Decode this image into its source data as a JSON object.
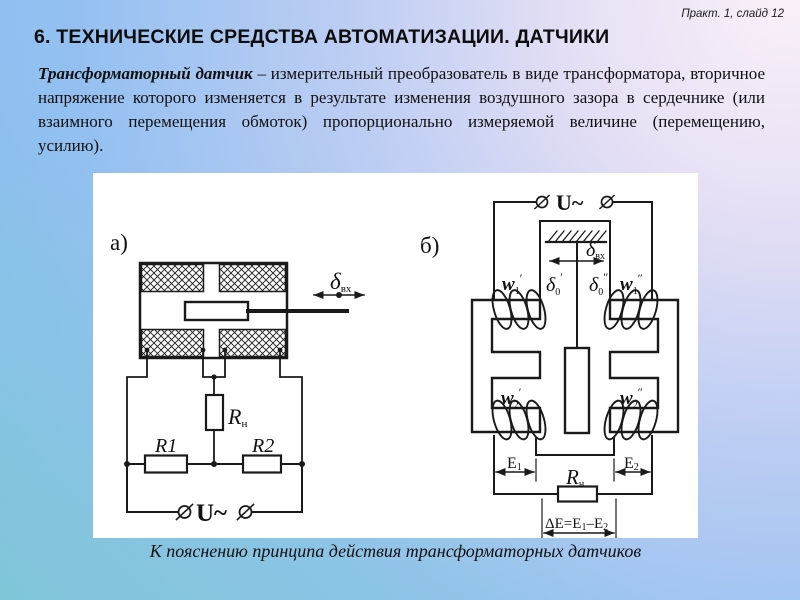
{
  "slide": {
    "ref": "Практ. 1, слайд 12",
    "title": "6. ТЕХНИЧЕСКИЕ СРЕДСТВА АВТОМАТИЗАЦИИ. ДАТЧИКИ"
  },
  "paragraph": {
    "lead": "Трансформаторный датчик",
    "rest": "– измерительный преобразователь в виде трансформатора, вторичное напряжение которого изменяется в результате изменения воздушного зазора в сердечнике (или взаимного перемещения обмоток) пропорционально измеряемой величине (перемещению, усилию)."
  },
  "figure": {
    "caption": "К пояснению принципа действия трансформаторных датчиков",
    "colors": {
      "ink": "#1a1a1a",
      "panel_bg": "#ffffff"
    },
    "panel_a": {
      "label": "а)",
      "delta_in": {
        "base": "δ",
        "sub": "вх"
      },
      "rn": {
        "base": "R",
        "sub": "н"
      },
      "r1": "R1",
      "r2": "R2",
      "supply": "U~"
    },
    "panel_b": {
      "label": "б)",
      "supply": "U~",
      "delta_in": {
        "base": "δ",
        "sub": "вх"
      },
      "delta0_left": {
        "base": "δ",
        "sub": "0",
        "sup": "′"
      },
      "delta0_right": {
        "base": "δ",
        "sub": "0",
        "sup": "″"
      },
      "w1_left": {
        "base": "w",
        "sub": "1",
        "sup": "′"
      },
      "w1_right": {
        "base": "w",
        "sub": "1",
        "sup": "″"
      },
      "w2_left": {
        "base": "w",
        "sub": "2",
        "sup": "′"
      },
      "w2_right": {
        "base": "w",
        "sub": "2",
        "sup": "″"
      },
      "e1": {
        "base": "E",
        "sub": "1"
      },
      "e2": {
        "base": "E",
        "sub": "2"
      },
      "rn": {
        "base": "R",
        "sub": "н"
      },
      "delta_e": {
        "p1": "ΔE=E",
        "s1": "1",
        "p2": "–E",
        "s2": "2"
      }
    }
  }
}
